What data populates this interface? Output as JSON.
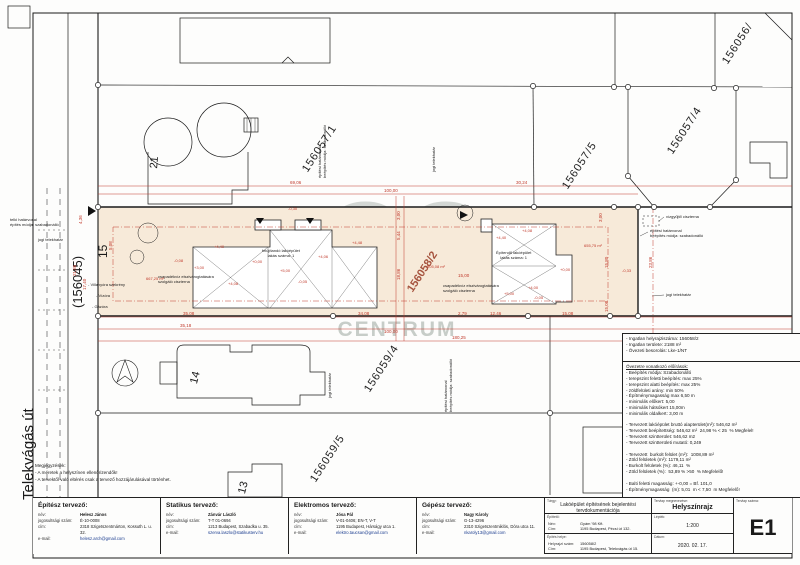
{
  "colors": {
    "dimension_red": "#c0392b",
    "site_beige": "#f7ead9",
    "watermark_gray": "#7d8a80",
    "parcel_label_brown": "#a6543f"
  },
  "watermark": {
    "logo": "OC",
    "line1": "OTTHON",
    "line2": "CENTRUM"
  },
  "plan": {
    "labels": [
      {
        "t": "156056/",
        "x": 720,
        "y": 60,
        "r": -57,
        "s": 11,
        "c": "pnum"
      },
      {
        "t": "156057/1",
        "x": 300,
        "y": 168,
        "r": -57,
        "s": 11,
        "c": "pnum"
      },
      {
        "t": "156057/5",
        "x": 560,
        "y": 185,
        "r": -57,
        "s": 11,
        "c": "pnum"
      },
      {
        "t": "156057/4",
        "x": 665,
        "y": 150,
        "r": -57,
        "s": 11,
        "c": "pnum"
      },
      {
        "t": "156059/4",
        "x": 362,
        "y": 388,
        "r": -57,
        "s": 11,
        "c": "pnum"
      },
      {
        "t": "156059/5",
        "x": 308,
        "y": 478,
        "r": -57,
        "s": 11,
        "c": "pnum"
      },
      {
        "t": "156058/2",
        "x": 405,
        "y": 288,
        "r": -57,
        "s": 11,
        "c": "brown"
      },
      {
        "t": "(156045)",
        "x": 70,
        "y": 308,
        "r": -90,
        "s": 13
      },
      {
        "t": "15",
        "x": 96,
        "y": 258,
        "r": -90,
        "s": 12
      },
      {
        "t": "Telekvágás út",
        "x": 20,
        "y": 500,
        "r": -90,
        "s": 15
      },
      {
        "t": "21",
        "x": 148,
        "y": 168,
        "r": -85,
        "s": 11
      },
      {
        "t": "14",
        "x": 188,
        "y": 382,
        "r": -75,
        "s": 11
      },
      {
        "t": "13",
        "x": 236,
        "y": 492,
        "r": -75,
        "s": 11
      },
      {
        "t": "telki határvonal\népítés módja: szabadonálló",
        "x": 10,
        "y": 218,
        "s": 4
      },
      {
        "t": "jogi telekhatár",
        "x": 38,
        "y": 238,
        "s": 4
      },
      {
        "t": "- Villanyóra szekrény",
        "x": 88,
        "y": 283,
        "s": 4
      },
      {
        "t": "- Vízóra",
        "x": 96,
        "y": 294,
        "s": 4
      },
      {
        "t": "- Gázóra",
        "x": 92,
        "y": 305,
        "s": 4
      },
      {
        "t": "csapadékvíz elszivárogtatására\nszolgáló ciszterna",
        "x": 158,
        "y": 275,
        "s": 4
      },
      {
        "t": "csapadékvíz elszivárogtatására\nszolgáló ciszterna",
        "x": 443,
        "y": 284,
        "s": 4
      },
      {
        "t": "vízgyűjtő ciszterna",
        "x": 666,
        "y": 215,
        "s": 4
      },
      {
        "t": "építési határvonal\nbeépítés módja: szabadonálló",
        "x": 650,
        "y": 229,
        "s": 4
      },
      {
        "t": "jogi telekhatár",
        "x": 666,
        "y": 293,
        "s": 4
      },
      {
        "t": "építési határvonal\nbeépítés módja: szabadonálló",
        "x": 318,
        "y": 178,
        "r": -90,
        "s": 4
      },
      {
        "t": "jogi telekhatár",
        "x": 432,
        "y": 172,
        "r": -90,
        "s": 4
      },
      {
        "t": "jogi telekhatár",
        "x": 328,
        "y": 398,
        "r": -90,
        "s": 4
      },
      {
        "t": "építési határvonal\nbeépítés módja: szabadonálló",
        "x": 444,
        "y": 412,
        "r": -90,
        "s": 4
      },
      {
        "t": "felújítandó lakóépület\nlakás száma: 1",
        "x": 262,
        "y": 249,
        "s": 4,
        "c": "ctr"
      },
      {
        "t": "Építendő lakóépület\nlakás száma: 1",
        "x": 496,
        "y": 251,
        "s": 4,
        "c": "ctr"
      },
      {
        "t": "69,06",
        "x": 290,
        "y": 180,
        "c": "red"
      },
      {
        "t": "100,00",
        "x": 384,
        "y": 188,
        "c": "red"
      },
      {
        "t": "30,24",
        "x": 516,
        "y": 180,
        "c": "red"
      },
      {
        "t": "35,08",
        "x": 183,
        "y": 311,
        "c": "red"
      },
      {
        "t": "34,08",
        "x": 358,
        "y": 311,
        "c": "red"
      },
      {
        "t": "2,79",
        "x": 458,
        "y": 311,
        "c": "red"
      },
      {
        "t": "12,46",
        "x": 490,
        "y": 311,
        "c": "red"
      },
      {
        "t": "15,08",
        "x": 562,
        "y": 311,
        "c": "red"
      },
      {
        "t": "35,18",
        "x": 180,
        "y": 323,
        "c": "red"
      },
      {
        "t": "100,00",
        "x": 384,
        "y": 329,
        "c": "red"
      },
      {
        "t": "180,25",
        "x": 452,
        "y": 335,
        "c": "red"
      },
      {
        "t": "15,00",
        "x": 458,
        "y": 273,
        "c": "red"
      },
      {
        "t": "4,36",
        "x": 78,
        "y": 224,
        "r": -90,
        "c": "red"
      },
      {
        "t": "21,86",
        "x": 72,
        "y": 276,
        "r": -90,
        "c": "red"
      },
      {
        "t": "17,40",
        "x": 82,
        "y": 290,
        "r": -90,
        "c": "red"
      },
      {
        "t": "5,08",
        "x": 108,
        "y": 250,
        "r": -90,
        "c": "red"
      },
      {
        "t": "3,00",
        "x": 598,
        "y": 222,
        "r": -90,
        "c": "red"
      },
      {
        "t": "15,80",
        "x": 604,
        "y": 268,
        "r": -90,
        "c": "red"
      },
      {
        "t": "23,86",
        "x": 648,
        "y": 268,
        "r": -90,
        "c": "red"
      },
      {
        "t": "15,08",
        "x": 604,
        "y": 312,
        "r": -90,
        "c": "red"
      },
      {
        "t": "3,00",
        "x": 396,
        "y": 220,
        "r": -90,
        "c": "red"
      },
      {
        "t": "5,44",
        "x": 396,
        "y": 240,
        "r": -90,
        "c": "red"
      },
      {
        "t": "18,86",
        "x": 396,
        "y": 280,
        "r": -90,
        "c": "red"
      },
      {
        "t": "+4,48",
        "x": 352,
        "y": 241,
        "s": 4,
        "c": "red"
      },
      {
        "t": "-0,30",
        "x": 288,
        "y": 207,
        "s": 4,
        "c": "red"
      },
      {
        "t": "-0,08",
        "x": 174,
        "y": 259,
        "s": 4,
        "c": "red"
      },
      {
        "t": "+3,00",
        "x": 194,
        "y": 266,
        "s": 4,
        "c": "red"
      },
      {
        "t": "+4,40",
        "x": 214,
        "y": 245,
        "s": 4,
        "c": "red"
      },
      {
        "t": "+4,08",
        "x": 228,
        "y": 282,
        "s": 4,
        "c": "red"
      },
      {
        "t": "+0,00",
        "x": 252,
        "y": 260,
        "s": 4,
        "c": "red"
      },
      {
        "t": "+5,00",
        "x": 280,
        "y": 269,
        "s": 4,
        "c": "red"
      },
      {
        "t": "-0,05",
        "x": 298,
        "y": 280,
        "s": 4,
        "c": "red"
      },
      {
        "t": "+4,06",
        "x": 318,
        "y": 255,
        "s": 4,
        "c": "red"
      },
      {
        "t": "667,25 m²",
        "x": 146,
        "y": 277,
        "s": 4,
        "c": "red"
      },
      {
        "t": "505,08 m²",
        "x": 427,
        "y": 265,
        "s": 4,
        "c": "red"
      },
      {
        "t": "655,75 m²",
        "x": 584,
        "y": 244,
        "s": 4,
        "c": "red"
      },
      {
        "t": "+4,08",
        "x": 522,
        "y": 229,
        "s": 4,
        "c": "red"
      },
      {
        "t": "+4,40",
        "x": 496,
        "y": 236,
        "s": 4,
        "c": "red"
      },
      {
        "t": "+0,00",
        "x": 560,
        "y": 268,
        "s": 4,
        "c": "red"
      },
      {
        "t": "+4,00",
        "x": 528,
        "y": 286,
        "s": 4,
        "c": "red"
      },
      {
        "t": "+5,00",
        "x": 504,
        "y": 292,
        "s": 4,
        "c": "red"
      },
      {
        "t": "-0,05",
        "x": 534,
        "y": 296,
        "s": 4,
        "c": "red"
      },
      {
        "t": "-0,33",
        "x": 622,
        "y": 269,
        "s": 4,
        "c": "red"
      }
    ]
  },
  "info1": [
    "- Ingatlan helyrajziszáma: 156058/2",
    "- Ingatlan területe: 2188 m²",
    "- Övezeti besorolás: Lke-1/NT"
  ],
  "info2": [
    {
      "t": "Övezetre vonatkozó előírások:",
      "c": "u"
    },
    "- Beépítés módja: Szabadonálló",
    "- terepszint feletti beépítés: max 25%",
    "- terepszint alatti beépítés: max 25%",
    "- zöldfelületi arány: min 50%",
    "- Építménymagasság max 6,50 m",
    "- minimális előkert: 5,00",
    "- minimális hátsókert 15,00m",
    "- minimális oldalkert: 3,00 m",
    "",
    "- Tervezett lakóépület bruttó alapterület(m²): 546,62 m²",
    "- Tervezett beépítettség: 546,62 m²  24,98 % < 25  % Megfelel!",
    "- Tervezett szintterület: 546,62 m2",
    "- Tervezett szintterületi mutató: 0,249",
    "",
    "- Tervezett  burkolt felület (m²):  1008,89 m²",
    "- Zöld felületek (m²): 1179,11 m²",
    "- Burkolt felületek (%): 46,11  %",
    "- Zöld felületek (%):  53,89 % >50  % Megfelelő!",
    "",
    "- Balti feletti magasság: +-0,00 = Bf. 101,0",
    "- Építménymagasság  (m): 5,01  m < 7,50  m Megfelelő!"
  ],
  "notes": {
    "title": "Megjegyzések:",
    "line1": "- A méretek a helyszínen ellenőrizendők!",
    "line2": "- A tervektől való eltérés csak a tervező hozzájárulásával történhet."
  },
  "titleblock": {
    "field_labels": {
      "name": "név:",
      "license": "jogosultsági szám:",
      "address": "cím:",
      "email": "e-mail:"
    },
    "designers": [
      {
        "heading": "Építész tervező:",
        "name": "Helesz János",
        "license": "É-10-0008",
        "address": "2318 Szigetszentmárton, Kossuth L. u. 32.",
        "email": "helesz.arch@gmail.com"
      },
      {
        "heading": "Statikus tervező:",
        "name": "Zánvár László",
        "license": "T-T 01-0694",
        "address": "1213 Budapest, Szabadka u. 35.",
        "email": "szerva.laszlo@statikusterv.hu"
      },
      {
        "heading": "Elektromos tervező:",
        "name": "Jósa Pál",
        "license": "V-01-0406; EN-T, V-T",
        "address": "1195 Budapest, Hárságy utca 1.",
        "email": "elektro.taucsan@gmail.com"
      },
      {
        "heading": "Gépész tervező:",
        "name": "Nagy Károly",
        "license": "G-13-4296",
        "address": "2310 Szigetszentmiklós, Dóra utca 11.",
        "email": "nkaroly13@gmail.com"
      }
    ],
    "right": {
      "subject_label": "Tárgy:",
      "project_title": "Lakóépület építésének bejelentési tervdokumentációja",
      "drawing_label": "Tervlap megnevezése:",
      "drawing_title": "Helyszínrajz",
      "client_label": "Építtető:",
      "client_name_key": "Név:",
      "client_name": "Gyám '98 Kft.",
      "client_addr_key": "Cím:",
      "client_addr": "1195 Budapest, Pécsi út 132.",
      "scale_label": "Lépték:",
      "scale": "1:200",
      "site_label": "Építés helye:",
      "site_hrsz_key": "Helyrajzi szám:",
      "site_hrsz": "156058/2",
      "site_addr_key": "Cím:",
      "site_addr": "1195 Budapest, Telekvágás út 15.",
      "date_label": "Dátum:",
      "date": "2020. 02. 17.",
      "sheet_label": "Tervlap száma:",
      "sheet_no": "E1"
    }
  }
}
